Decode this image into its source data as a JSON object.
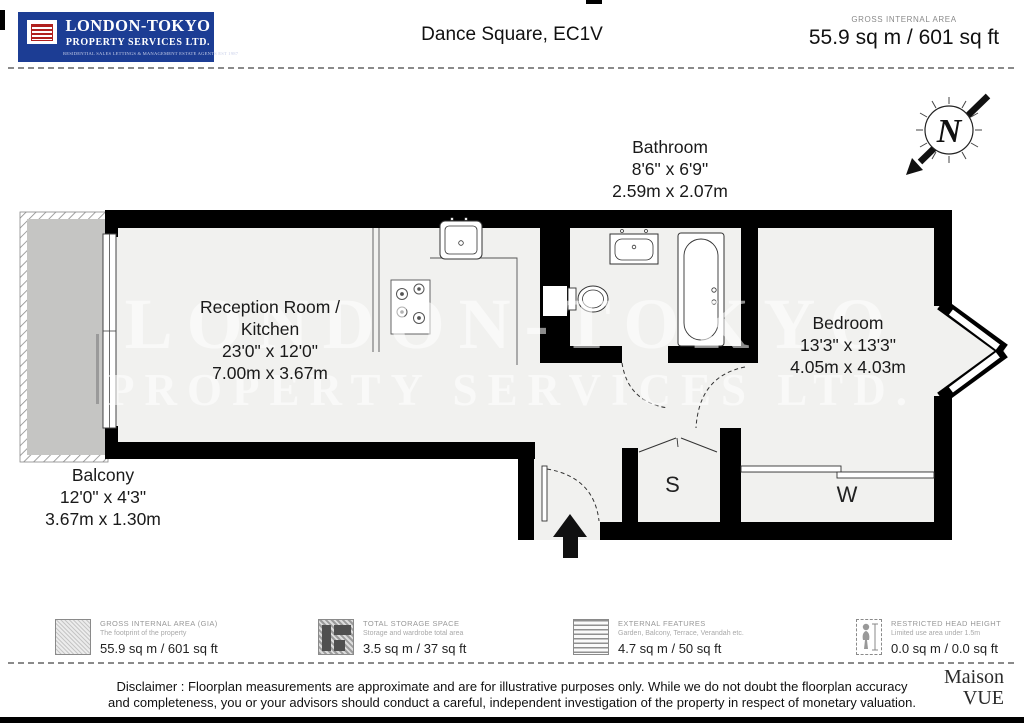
{
  "header": {
    "logo": {
      "line1": "LONDON-TOKYO",
      "line2": "PROPERTY SERVICES LTD.",
      "line3": "RESIDENTIAL SALES LETTINGS & MANAGEMENT ESTATE AGENTS EST 1987"
    },
    "title": "Dance Square, EC1V",
    "gia_label": "GROSS INTERNAL AREA",
    "gia_value": "55.9 sq m / 601 sq ft"
  },
  "compass": {
    "letter": "N"
  },
  "rooms": {
    "bathroom": {
      "name": "Bathroom",
      "imperial": "8'6\" x 6'9\"",
      "metric": "2.59m x 2.07m"
    },
    "reception": {
      "name1": "Reception Room /",
      "name2": "Kitchen",
      "imperial": "23'0\" x 12'0\"",
      "metric": "7.00m x 3.67m"
    },
    "bedroom": {
      "name": "Bedroom",
      "imperial": "13'3\" x 13'3\"",
      "metric": "4.05m x 4.03m"
    },
    "balcony": {
      "name": "Balcony",
      "imperial": "12'0\" x 4'3\"",
      "metric": "3.67m x 1.30m"
    },
    "storage_label": "S",
    "wardrobe_label": "W"
  },
  "watermark": {
    "line1": "LONDON-TOKYO",
    "line2": "PROPERTY SERVICES LTD."
  },
  "legend": {
    "items": [
      {
        "icon": "gia-swatch-icon",
        "title": "GROSS INTERNAL AREA (GIA)",
        "subtitle": "The footprint of the property",
        "value": "55.9 sq m / 601 sq ft"
      },
      {
        "icon": "storage-swatch-icon",
        "title": "TOTAL STORAGE SPACE",
        "subtitle": "Storage and wardrobe total area",
        "value": "3.5 sq m / 37 sq ft"
      },
      {
        "icon": "external-features-swatch-icon",
        "title": "EXTERNAL FEATURES",
        "subtitle": "Garden, Balcony, Terrace, Verandah etc.",
        "value": "4.7 sq m / 50 sq ft"
      },
      {
        "icon": "person-icon",
        "title": "RESTRICTED HEAD HEIGHT",
        "subtitle": "Limited use area under 1.5m",
        "value": "0.0 sq m / 0.0 sq ft"
      }
    ]
  },
  "footer": {
    "disclaimer_line1": "Disclaimer : Floorplan measurements are approximate and are for illustrative purposes only. While we do not doubt the floorplan accuracy",
    "disclaimer_line2": "and completeness, you or your advisors should conduct a careful, independent investigation of the property in respect of monetary valuation.",
    "brand_line1": "Maison",
    "brand_line2": "VUE"
  },
  "colors": {
    "logo_blue": "#1c3d94",
    "emblem_red": "#b0201e",
    "wall_black": "#000000",
    "floor_fill": "#f1f1ef",
    "balcony_fill": "#c5c5c3"
  }
}
